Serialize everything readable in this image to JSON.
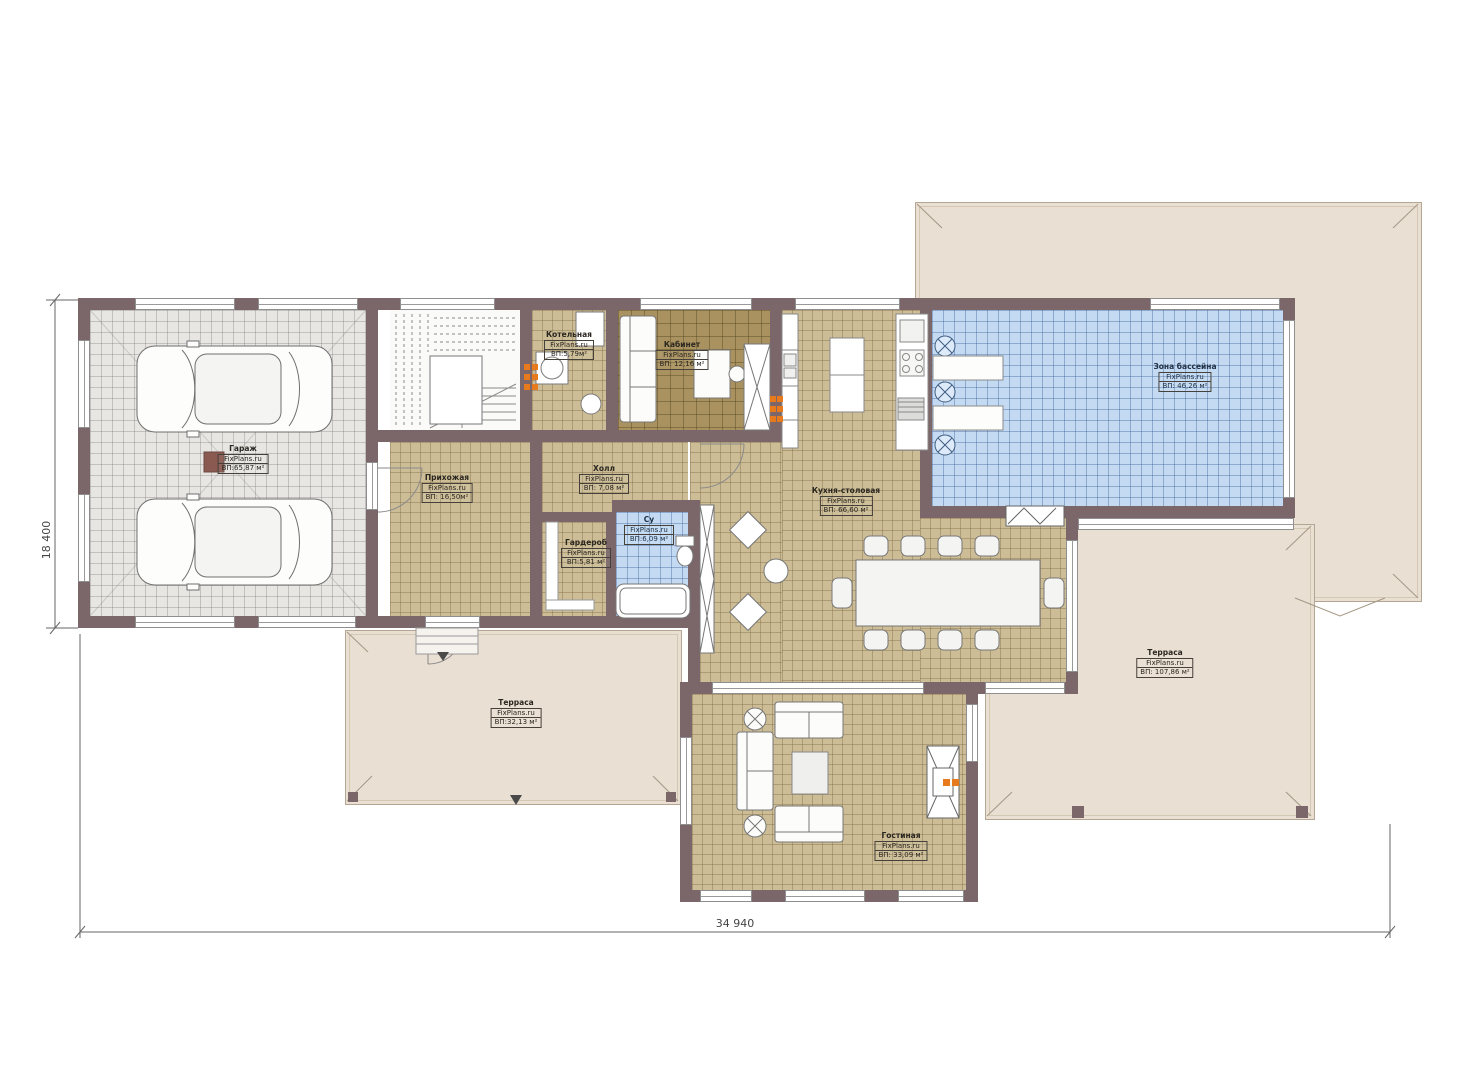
{
  "palette": {
    "wall": "#7b6769",
    "floor_tan": "#ccbd96",
    "floor_olive": "#a9925f",
    "floor_gray": "#e8e6e2",
    "pool_blue": "#c3daf2",
    "terrace": "#e9dfd2",
    "accent_orange": "#e87a1e"
  },
  "plan": {
    "brand": "FixPlans.ru",
    "dimensions": {
      "width_label": "34 940",
      "height_label": "18 400"
    },
    "rooms": [
      {
        "id": "garage",
        "name": "Гараж",
        "brand": "FixPlans.ru",
        "area": "ВП:65,87 м²"
      },
      {
        "id": "boiler",
        "name": "Котельная",
        "brand": "FixPlans.ru",
        "area": "ВП:5,79м²"
      },
      {
        "id": "office",
        "name": "Кабинет",
        "brand": "FixPlans.ru",
        "area": "ВП: 12,16 м²"
      },
      {
        "id": "entry",
        "name": "Прихожая",
        "brand": "FixPlans.ru",
        "area": "ВП: 16,50м²"
      },
      {
        "id": "hall",
        "name": "Холл",
        "brand": "FixPlans.ru",
        "area": "ВП: 7,08 м²"
      },
      {
        "id": "wardrobe",
        "name": "Гардероб",
        "brand": "FixPlans.ru",
        "area": "ВП:5,81 м²"
      },
      {
        "id": "bath",
        "name": "Су",
        "brand": "FixPlans.ru",
        "area": "ВП:6,09 м²"
      },
      {
        "id": "kitchen",
        "name": "Кухня-столовая",
        "brand": "FixPlans.ru",
        "area": "ВП: 66,60 м²"
      },
      {
        "id": "pool",
        "name": "Зона бассейна",
        "brand": "FixPlans.ru",
        "area": "ВП: 46,26 м²"
      },
      {
        "id": "terrace_left",
        "name": "Терраса",
        "brand": "FixPlans.ru",
        "area": "ВП:32,13 м²"
      },
      {
        "id": "terrace_right",
        "name": "Терраса",
        "brand": "FixPlans.ru",
        "area": "ВП: 107,86 м²"
      },
      {
        "id": "living",
        "name": "Гостиная",
        "brand": "FixPlans.ru",
        "area": "ВП: 33,09 м²"
      }
    ]
  }
}
